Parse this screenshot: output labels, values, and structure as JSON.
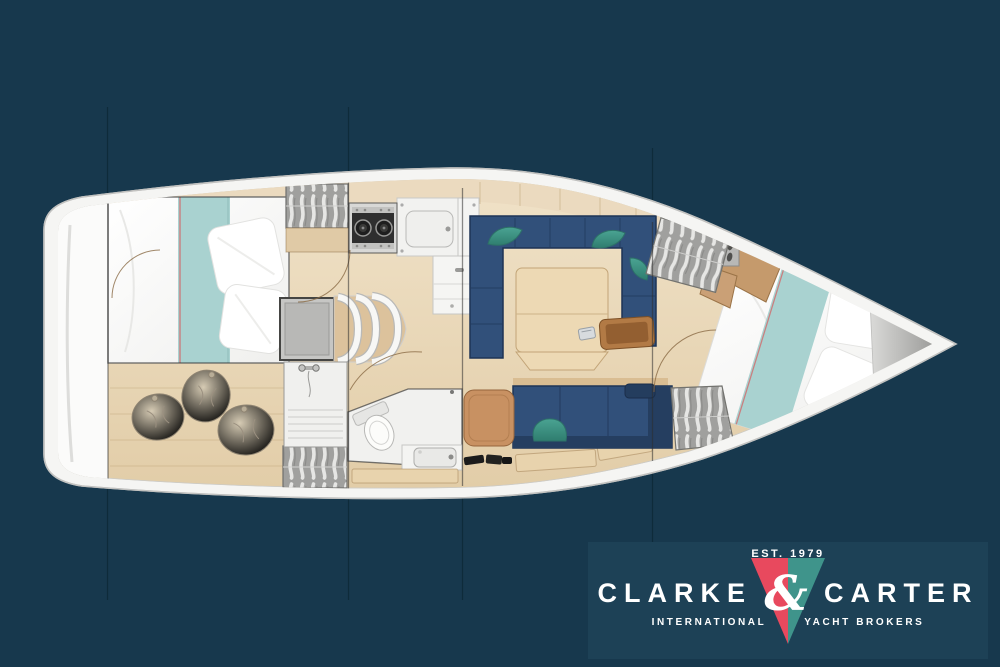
{
  "page": {
    "background_color": "#17384d"
  },
  "logo": {
    "established": "EST. 1979",
    "name_left": "CLARKE",
    "ampersand": "&",
    "name_right": "CARTER",
    "subtitle_left": "INTERNATIONAL",
    "subtitle_right": "YACHT BROKERS",
    "panel_color": "#1d4156",
    "colors": {
      "red": "#e8495e",
      "teal": "#3f948b",
      "text": "#ffffff"
    }
  },
  "floorplan": {
    "type": "sailing-yacht-interior-layout",
    "orientation": "bow-right",
    "rooms": [
      "aft cabin",
      "companionway",
      "galley",
      "shower",
      "head",
      "saloon",
      "chart seat",
      "forward cabin",
      "anchor locker"
    ],
    "features": [
      "double berth with teal runner",
      "three bean bags",
      "hanging lockers",
      "two-burner stove",
      "sink",
      "companionway steps",
      "U-shaped settee",
      "saloon table",
      "straight settee",
      "toilet",
      "washbasin",
      "V-berth",
      "bow locker"
    ],
    "colors": {
      "hull": "#f5f5f3",
      "deck_trim": "#c2c2c0",
      "floor_wood": "#e9d8bb",
      "cabinet_wood": "#c59a6c",
      "upholstery_navy": "#31507a",
      "bedding_teal": "#a9d2d0",
      "cushion_teal": "#3f948a"
    }
  }
}
